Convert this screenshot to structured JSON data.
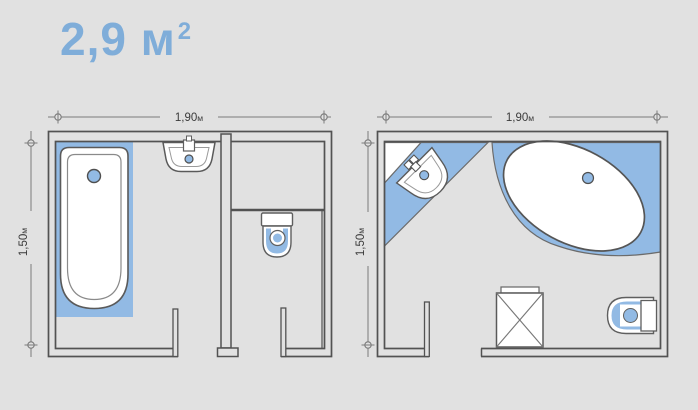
{
  "title": {
    "value": "2,9",
    "unit": "м",
    "superscript": "2"
  },
  "colors": {
    "background": "#e1e1e1",
    "fixture_blue": "#92bae4",
    "title_blue": "#7fadd9",
    "wall_line": "#525252",
    "dimension_text": "#3a3a3a"
  },
  "plans": {
    "left": {
      "width": {
        "value": "1,90",
        "unit": "м"
      },
      "height": {
        "value": "1,50",
        "unit": "м"
      },
      "fixtures": [
        "bathtub",
        "washbasin",
        "toilet"
      ]
    },
    "right": {
      "width": {
        "value": "1,90",
        "unit": "м"
      },
      "height": {
        "value": "1,50",
        "unit": "м"
      },
      "fixtures": [
        "corner-washbasin",
        "oval-bathtub",
        "washing-machine",
        "toilet"
      ]
    }
  }
}
